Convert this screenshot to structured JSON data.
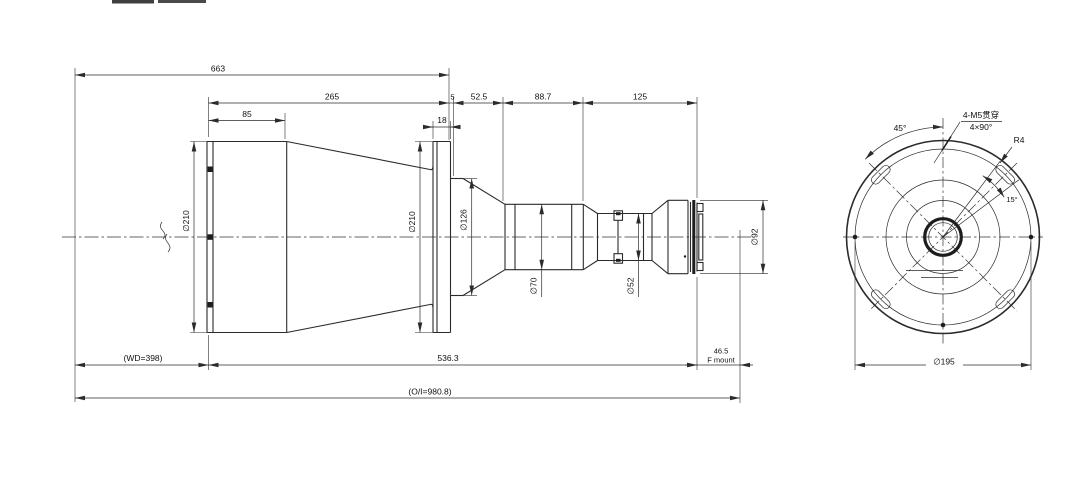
{
  "colors": {
    "line": "#2b2b2b",
    "background": "#ffffff"
  },
  "side_view": {
    "top_dims": {
      "overall": "663",
      "d265": "265",
      "d85": "85",
      "d18": "18",
      "d5": "5",
      "d52_5": "52.5",
      "d88_7": "88.7",
      "d125": "125"
    },
    "diameters": {
      "front": "∅210",
      "flange": "∅210",
      "d126": "∅126",
      "d70": "∅70",
      "d52": "∅52",
      "d92": "∅92"
    },
    "bottom_dims": {
      "wd": "(WD=398)",
      "d536": "536.3",
      "d46": "46.5",
      "mount": "F mount",
      "oi": "(O/I=980.8)"
    }
  },
  "front_view": {
    "angle45": "45°",
    "holes_line1": "4-M5贯穿",
    "holes_line2": "4×90°",
    "r4": "R4",
    "angle15": "15°",
    "d195": "∅195"
  }
}
